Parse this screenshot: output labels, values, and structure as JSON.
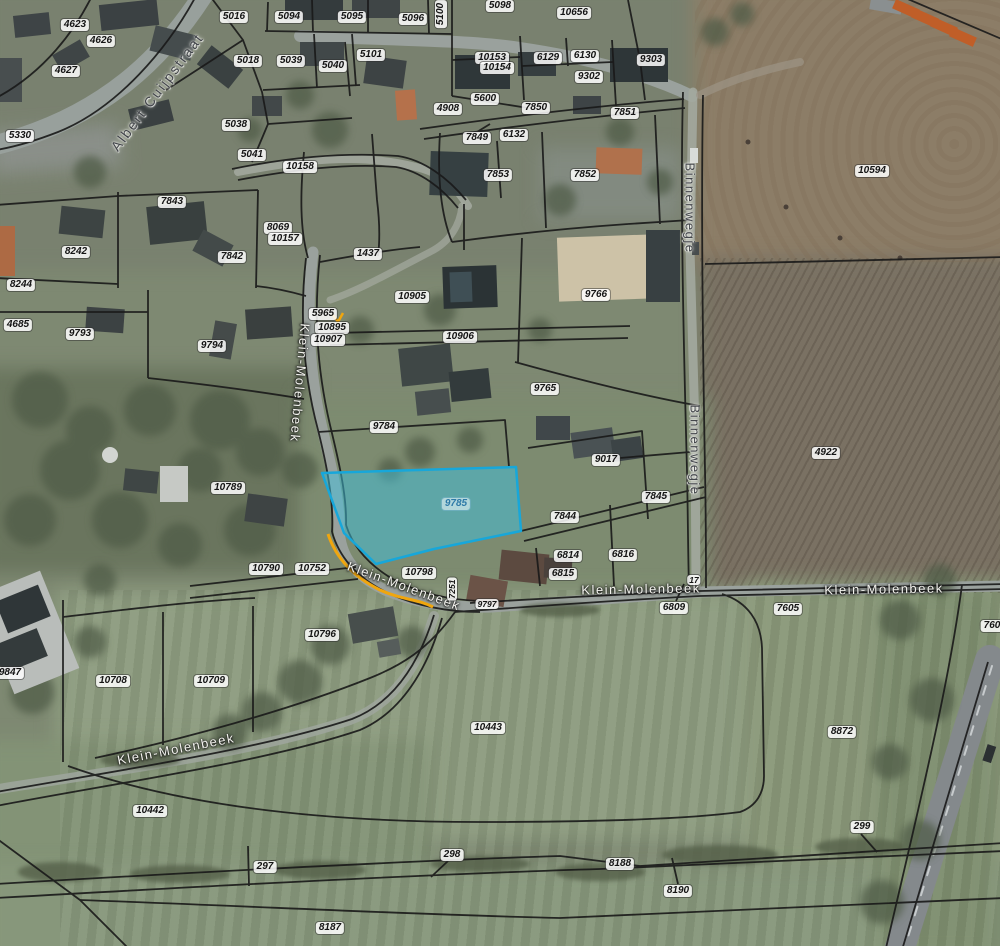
{
  "map": {
    "highlight": {
      "parcel": "9785",
      "fill_color": "#3fc1dd",
      "fill_opacity": 0.5,
      "stroke_color": "#17a7da",
      "label_color": "#2e7aa8"
    },
    "accent": {
      "selected_road_color": "#f0a60e"
    },
    "parcel_labels": [
      {
        "t": "4623",
        "x": 75,
        "y": 25
      },
      {
        "t": "4626",
        "x": 101,
        "y": 41
      },
      {
        "t": "4627",
        "x": 66,
        "y": 71
      },
      {
        "t": "5330",
        "x": 20,
        "y": 136
      },
      {
        "t": "5016",
        "x": 234,
        "y": 17
      },
      {
        "t": "5094",
        "x": 289,
        "y": 17
      },
      {
        "t": "5095",
        "x": 352,
        "y": 17
      },
      {
        "t": "5096",
        "x": 413,
        "y": 19
      },
      {
        "t": "5100",
        "x": 441,
        "y": 14,
        "r": -90
      },
      {
        "t": "5098",
        "x": 500,
        "y": 6
      },
      {
        "t": "10656",
        "x": 574,
        "y": 13
      },
      {
        "t": "5018",
        "x": 248,
        "y": 61
      },
      {
        "t": "5039",
        "x": 291,
        "y": 61
      },
      {
        "t": "5040",
        "x": 333,
        "y": 66
      },
      {
        "t": "5101",
        "x": 371,
        "y": 55
      },
      {
        "t": "10153",
        "x": 492,
        "y": 58
      },
      {
        "t": "10154",
        "x": 497,
        "y": 68
      },
      {
        "t": "6129",
        "x": 548,
        "y": 58
      },
      {
        "t": "6130",
        "x": 585,
        "y": 56
      },
      {
        "t": "9302",
        "x": 589,
        "y": 77
      },
      {
        "t": "9303",
        "x": 651,
        "y": 60
      },
      {
        "t": "5038",
        "x": 236,
        "y": 125
      },
      {
        "t": "5041",
        "x": 252,
        "y": 155
      },
      {
        "t": "10158",
        "x": 300,
        "y": 167
      },
      {
        "t": "5600",
        "x": 485,
        "y": 99
      },
      {
        "t": "4908",
        "x": 448,
        "y": 109
      },
      {
        "t": "7850",
        "x": 536,
        "y": 108
      },
      {
        "t": "7851",
        "x": 625,
        "y": 113
      },
      {
        "t": "6132",
        "x": 514,
        "y": 135
      },
      {
        "t": "7849",
        "x": 477,
        "y": 138
      },
      {
        "t": "7853",
        "x": 498,
        "y": 175
      },
      {
        "t": "7852",
        "x": 585,
        "y": 175
      },
      {
        "t": "10594",
        "x": 872,
        "y": 171
      },
      {
        "t": "7843",
        "x": 172,
        "y": 202
      },
      {
        "t": "8069",
        "x": 278,
        "y": 228
      },
      {
        "t": "10157",
        "x": 285,
        "y": 239
      },
      {
        "t": "8242",
        "x": 76,
        "y": 252
      },
      {
        "t": "7842",
        "x": 232,
        "y": 257
      },
      {
        "t": "8244",
        "x": 21,
        "y": 285
      },
      {
        "t": "4685",
        "x": 18,
        "y": 325
      },
      {
        "t": "9793",
        "x": 80,
        "y": 334
      },
      {
        "t": "9794",
        "x": 212,
        "y": 346
      },
      {
        "t": "1437",
        "x": 368,
        "y": 254
      },
      {
        "t": "10905",
        "x": 412,
        "y": 297
      },
      {
        "t": "5965",
        "x": 323,
        "y": 314
      },
      {
        "t": "10895",
        "x": 332,
        "y": 328
      },
      {
        "t": "10907",
        "x": 328,
        "y": 340
      },
      {
        "t": "10906",
        "x": 460,
        "y": 337
      },
      {
        "t": "9766",
        "x": 596,
        "y": 295
      },
      {
        "t": "9765",
        "x": 545,
        "y": 389
      },
      {
        "t": "9017",
        "x": 606,
        "y": 460
      },
      {
        "t": "9784",
        "x": 384,
        "y": 427
      },
      {
        "t": "4922",
        "x": 826,
        "y": 453
      },
      {
        "t": "10789",
        "x": 228,
        "y": 488
      },
      {
        "t": "9785",
        "x": 456,
        "y": 504,
        "hl": true
      },
      {
        "t": "7844",
        "x": 565,
        "y": 517
      },
      {
        "t": "7845",
        "x": 656,
        "y": 497
      },
      {
        "t": "6814",
        "x": 568,
        "y": 556
      },
      {
        "t": "6815",
        "x": 563,
        "y": 574
      },
      {
        "t": "6816",
        "x": 623,
        "y": 555
      },
      {
        "t": "10790",
        "x": 266,
        "y": 569
      },
      {
        "t": "10752",
        "x": 312,
        "y": 569
      },
      {
        "t": "10798",
        "x": 419,
        "y": 573
      },
      {
        "t": "7251",
        "x": 452,
        "y": 589,
        "r": -90,
        "s": true
      },
      {
        "t": "9797",
        "x": 487,
        "y": 604,
        "s": true
      },
      {
        "t": "17",
        "x": 694,
        "y": 580,
        "s": true
      },
      {
        "t": "6809",
        "x": 674,
        "y": 608
      },
      {
        "t": "7605",
        "x": 788,
        "y": 609
      },
      {
        "t": "760",
        "x": 992,
        "y": 626
      },
      {
        "t": "9847",
        "x": 10,
        "y": 673
      },
      {
        "t": "10708",
        "x": 113,
        "y": 681
      },
      {
        "t": "10709",
        "x": 211,
        "y": 681
      },
      {
        "t": "10796",
        "x": 322,
        "y": 635
      },
      {
        "t": "10443",
        "x": 488,
        "y": 728
      },
      {
        "t": "8872",
        "x": 842,
        "y": 732
      },
      {
        "t": "10442",
        "x": 150,
        "y": 811
      },
      {
        "t": "297",
        "x": 265,
        "y": 867
      },
      {
        "t": "298",
        "x": 452,
        "y": 855
      },
      {
        "t": "8188",
        "x": 620,
        "y": 864
      },
      {
        "t": "8190",
        "x": 678,
        "y": 891
      },
      {
        "t": "299",
        "x": 862,
        "y": 827
      },
      {
        "t": "8187",
        "x": 330,
        "y": 928
      }
    ],
    "street_labels": [
      {
        "t": "Albert Cuijpstraat",
        "x": 157,
        "y": 92,
        "r": -53,
        "v": "dark",
        "big": true
      },
      {
        "t": "Klein-Molenbeek",
        "x": 300,
        "y": 383,
        "r": 95,
        "v": "light"
      },
      {
        "t": "Binnenwegje",
        "x": 690,
        "y": 208,
        "r": 90,
        "v": "dark"
      },
      {
        "t": "Binnenwegje",
        "x": 695,
        "y": 450,
        "r": 90,
        "v": "dark"
      },
      {
        "t": "Klein-Molenbeek",
        "x": 404,
        "y": 586,
        "r": 20,
        "v": "light"
      },
      {
        "t": "Klein-Molenbeek",
        "x": 641,
        "y": 589,
        "r": -1,
        "v": "light"
      },
      {
        "t": "Klein-Molenbeek",
        "x": 884,
        "y": 589,
        "r": -1,
        "v": "light"
      },
      {
        "t": "Klein-Molenbeek",
        "x": 176,
        "y": 749,
        "r": -11,
        "v": "light"
      }
    ]
  }
}
